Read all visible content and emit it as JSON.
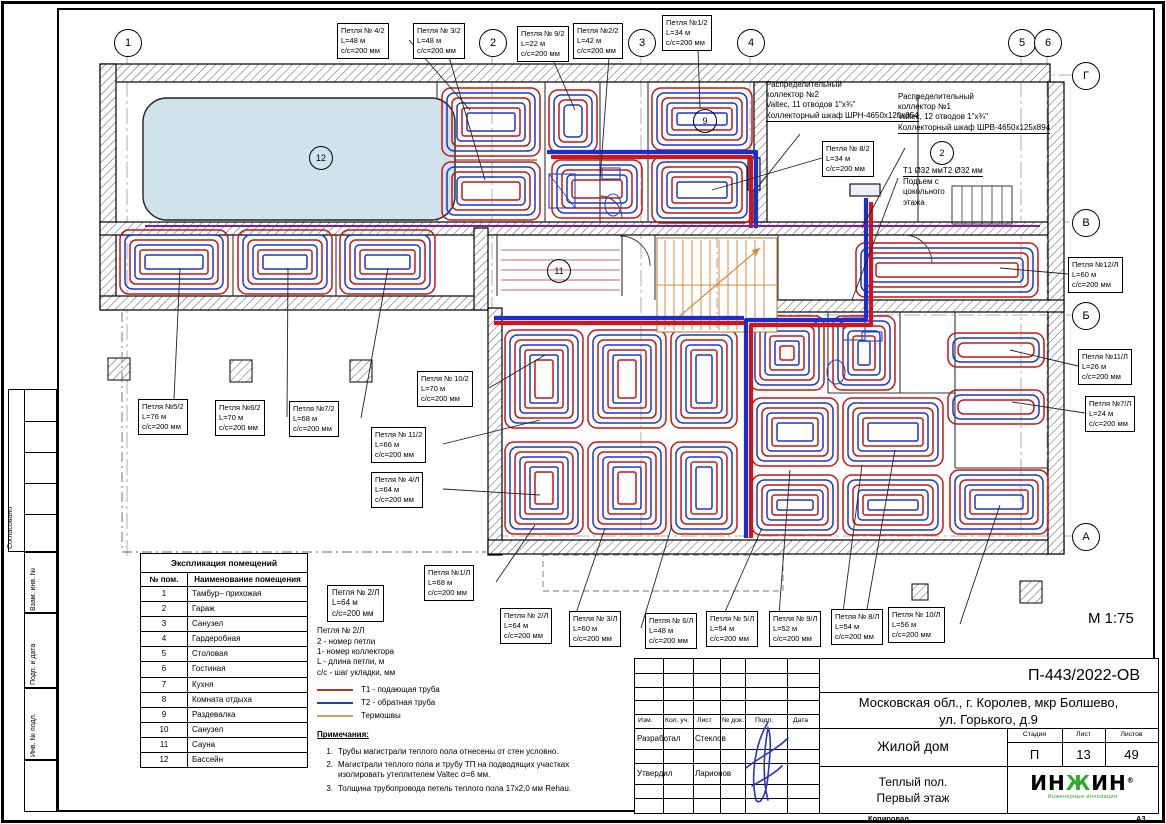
{
  "sheet": {
    "scale": "М 1:75",
    "copied": "Копировал",
    "format": "А3"
  },
  "side_strip": {
    "labels": [
      "Согласовано",
      "Взам. инв. №",
      "Подп. и дата",
      "Инв. № подл."
    ]
  },
  "axes": {
    "top": [
      {
        "label": "1",
        "x": 127
      },
      {
        "label": "2",
        "x": 492
      },
      {
        "label": "3",
        "x": 641
      },
      {
        "label": "4",
        "x": 750
      },
      {
        "label": "5",
        "x": 1021
      },
      {
        "label": "6",
        "x": 1047
      }
    ],
    "right": [
      {
        "label": "Г",
        "y": 75
      },
      {
        "label": "В",
        "y": 222
      },
      {
        "label": "Б",
        "y": 315
      },
      {
        "label": "А",
        "y": 536
      }
    ]
  },
  "room_circles": [
    {
      "n": "12",
      "x": 320,
      "y": 157
    },
    {
      "n": "11",
      "x": 558,
      "y": 270
    },
    {
      "n": "9",
      "x": 704,
      "y": 120
    },
    {
      "n": "2",
      "x": 941,
      "y": 152
    }
  ],
  "loop_labels": [
    {
      "t": "Петля № 4/2",
      "l": "L=48 м",
      "s": "с/с=200 мм",
      "x": 337,
      "y": 23,
      "tx": 470,
      "ty": 110
    },
    {
      "t": "Петля № 3/2",
      "l": "L=48 м",
      "s": "с/с=200 мм",
      "x": 413,
      "y": 23,
      "tx": 485,
      "ty": 180
    },
    {
      "t": "Петля № 9/2",
      "l": "L=22 м",
      "s": "с/с=200 мм",
      "x": 517,
      "y": 26,
      "tx": 575,
      "ty": 110
    },
    {
      "t": "Петля №2/2",
      "l": "L=42 м",
      "s": "с/с=200 мм",
      "x": 573,
      "y": 23,
      "tx": 600,
      "ty": 180
    },
    {
      "t": "Петля №1/2",
      "l": "L=34 м",
      "s": "с/с=200 мм",
      "x": 662,
      "y": 15,
      "tx": 700,
      "ty": 108
    },
    {
      "t": "Петля № 8/2",
      "l": "L=34 м",
      "s": "с/с=200 мм",
      "x": 822,
      "y": 141,
      "tx": 712,
      "ty": 190
    },
    {
      "t": "Петля №12/Л",
      "l": "L=60 м",
      "s": "с/с=200 мм",
      "x": 1068,
      "y": 257,
      "tx": 1000,
      "ty": 268
    },
    {
      "t": "Петля №11/Л",
      "l": "L=26 м",
      "s": "с/с=200 мм",
      "x": 1078,
      "y": 349,
      "tx": 1010,
      "ty": 350
    },
    {
      "t": "Петля №7/Л",
      "l": "L=24 м",
      "s": "с/с=200 мм",
      "x": 1085,
      "y": 396,
      "tx": 1012,
      "ty": 402
    },
    {
      "t": "Петля №5/2",
      "l": "L=76 м",
      "s": "с/с=200 мм",
      "x": 138,
      "y": 399,
      "tx": 180,
      "ty": 268
    },
    {
      "t": "Петля №6/2",
      "l": "L=70 м",
      "s": "с/с=200 мм",
      "x": 215,
      "y": 400,
      "tx": 288,
      "ty": 268
    },
    {
      "t": "Петля №7/2",
      "l": "L=68 м",
      "s": "с/с=200 мм",
      "x": 289,
      "y": 401,
      "tx": 388,
      "ty": 268
    },
    {
      "t": "Петля № 10/2",
      "l": "L=70 м",
      "s": "с/с=200 мм",
      "x": 417,
      "y": 371,
      "tx": 545,
      "ty": 355
    },
    {
      "t": "Петля № 11/2",
      "l": "L=66 м",
      "s": "с/с=200 мм",
      "x": 371,
      "y": 427,
      "tx": 540,
      "ty": 420
    },
    {
      "t": "Петля № 4/Л",
      "l": "L=64 м",
      "s": "с/с=200 мм",
      "x": 371,
      "y": 472,
      "tx": 540,
      "ty": 495
    },
    {
      "t": "Петля №1/Л",
      "l": "L=68 м",
      "s": "с/с=200 мм",
      "x": 424,
      "y": 565,
      "tx": 535,
      "ty": 525
    },
    {
      "t": "Петля № 2/Л",
      "l": "L=64 м",
      "s": "с/с=200 мм",
      "x": 500,
      "y": 608,
      "tx": 605,
      "ty": 528
    },
    {
      "t": "Петля № 3/Л",
      "l": "L=60 м",
      "s": "с/с=200 мм",
      "x": 569,
      "y": 611,
      "tx": 672,
      "ty": 525
    },
    {
      "t": "Петля № 6/Л",
      "l": "L=48 м",
      "s": "с/с=200 мм",
      "x": 645,
      "y": 613,
      "tx": 762,
      "ty": 528
    },
    {
      "t": "Петля № 5/Л",
      "l": "L=54 м",
      "s": "с/с=200 мм",
      "x": 706,
      "y": 611,
      "tx": 790,
      "ty": 470
    },
    {
      "t": "Петля № 9/Л",
      "l": "L=52 м",
      "s": "с/с=200 мм",
      "x": 769,
      "y": 611,
      "tx": 862,
      "ty": 465
    },
    {
      "t": "Петля № 8/Л",
      "l": "L=54 м",
      "s": "с/с=200 мм",
      "x": 831,
      "y": 609,
      "tx": 895,
      "ty": 450
    },
    {
      "t": "Петля № 10/Л",
      "l": "L=56 м",
      "s": "с/с=200 мм",
      "x": 888,
      "y": 607,
      "tx": 1000,
      "ty": 505
    }
  ],
  "collector_notes": [
    {
      "x": 766,
      "y": 80,
      "lines": [
        "Распределительный",
        "коллектор №2",
        "Valtec, 11 отводов 1\"х¾\"",
        "Коллекторный шкаф ШРН-4",
        "650х120х854"
      ],
      "leader": [
        800,
        134,
        757,
        188
      ]
    },
    {
      "x": 898,
      "y": 92,
      "lines": [
        "Распределительный",
        "коллектор №1",
        "Valtec, 12 отводов 1\"х¾\"",
        "Коллекторный шкаф ШРВ-4",
        "650х125х894"
      ],
      "leader": [
        905,
        148,
        862,
        228
      ]
    }
  ],
  "riser_note": {
    "x": 903,
    "y": 166,
    "lines": [
      "Т1 Ø32 мм",
      "Т2 Ø32 мм",
      "Подъем с",
      "цокольного",
      "этажа"
    ],
    "leader": [
      898,
      178,
      852,
      300
    ]
  },
  "room_schedule": {
    "title": "Экспликация помещений",
    "col_num": "№ пом.",
    "col_name": "Наименование помещения",
    "rows": [
      [
        "1",
        "Тамбур– прихожая"
      ],
      [
        "2",
        "Гараж"
      ],
      [
        "3",
        "Санузел"
      ],
      [
        "4",
        "Гардеробная"
      ],
      [
        "5",
        "Столовая"
      ],
      [
        "6",
        "Гостиная"
      ],
      [
        "7",
        "Кухня"
      ],
      [
        "8",
        "Комната отдыха"
      ],
      [
        "9",
        "Раздевалка"
      ],
      [
        "10",
        "Санузел"
      ],
      [
        "11",
        "Сауна"
      ],
      [
        "12",
        "Бассейн"
      ]
    ]
  },
  "legend": {
    "sample": {
      "title": "Петля № 2/Л",
      "length": "L=64 м",
      "step": "с/с=200 мм"
    },
    "key_title": "Петля № 2/Л",
    "key_lines": [
      "2 - номер петли",
      "1- номер коллектора",
      "L - длина петли, м",
      "с/с - шаг укладки, мм"
    ],
    "line_items": [
      {
        "label": "Т1 - подающая труба",
        "color": "#b03a2e"
      },
      {
        "label": "Т2 - обратная труба",
        "color": "#1a3fbb"
      },
      {
        "label": "Термошвы",
        "color": "#c8a06a"
      }
    ],
    "notes_title": "Примечания:",
    "notes": [
      "Трубы магистрали теплого пола отнесены от стен условно.",
      "Магистрали теплого пола и трубу ТП на подводящих участках изолировать утеплителем Valtec σ=6 мм.",
      "Толщина трубопровода петель теплого пола 17х2,0 мм Rehau."
    ]
  },
  "title_block": {
    "doc_number": "П-443/2022-ОВ",
    "address_line1": "Московская обл., г. Королев, мкр Болшево,",
    "address_line2": "ул. Горького, д.9",
    "object_name": "Жилой дом",
    "drawing_title_line1": "Теплый пол.",
    "drawing_title_line2": "Первый этаж",
    "stage_label": "Стадия",
    "sheet_label": "Лист",
    "sheets_label": "Листов",
    "stage": "П",
    "sheet_no": "13",
    "sheets_total": "49",
    "columns": [
      "Изм.",
      "Кол. уч.",
      "Лист",
      "№ док.",
      "Подп.",
      "Дата"
    ],
    "developed_label": "Разработал",
    "developed_name": "Стеклов",
    "approved_label": "Утвердил",
    "approved_name": "Ларионов",
    "logo_text_a": "ИН",
    "logo_text_g": "Ж",
    "logo_text_b": "ИН",
    "logo_sub": "Инженерные инновации",
    "logo_reg": "®"
  },
  "colors": {
    "pipe_supply": "#c81414",
    "pipe_return": "#1a35c8",
    "main_blue": "#1530cf",
    "main_red": "#cf1515",
    "thermo": "#c8a06a",
    "pool": "#cfe3ed",
    "stairs": "#d98a3c",
    "logo_green": "#2ea82e",
    "signature": "#2a35c0"
  }
}
